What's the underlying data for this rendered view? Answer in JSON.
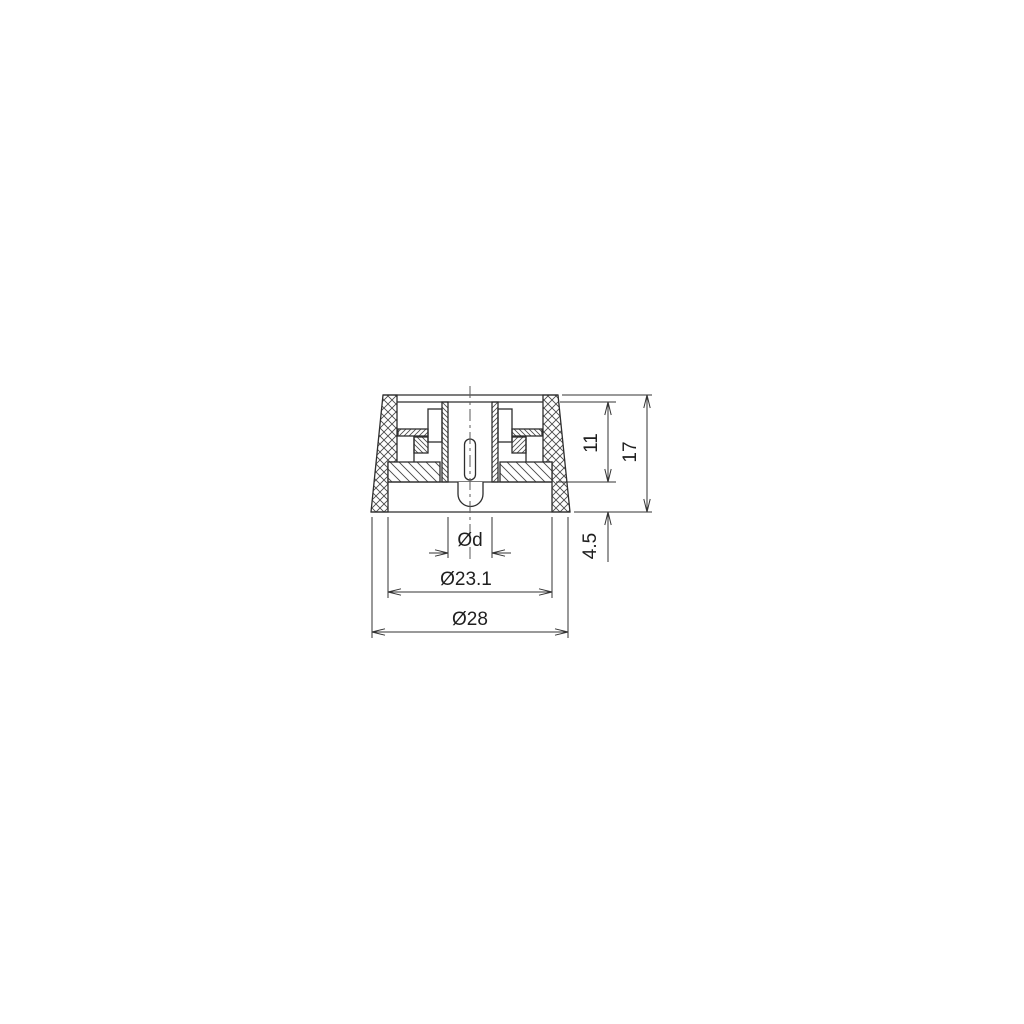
{
  "drawing": {
    "background_color": "#ffffff",
    "line_color": "#2e2e2e",
    "dimension_line_color": "#333333",
    "dimensions": {
      "inner_depth": "11",
      "total_height": "17",
      "skirt_height": "4.5",
      "shaft_diameter": "Ød",
      "inner_diameter": "Ø23.1",
      "outer_diameter": "Ø28"
    }
  }
}
